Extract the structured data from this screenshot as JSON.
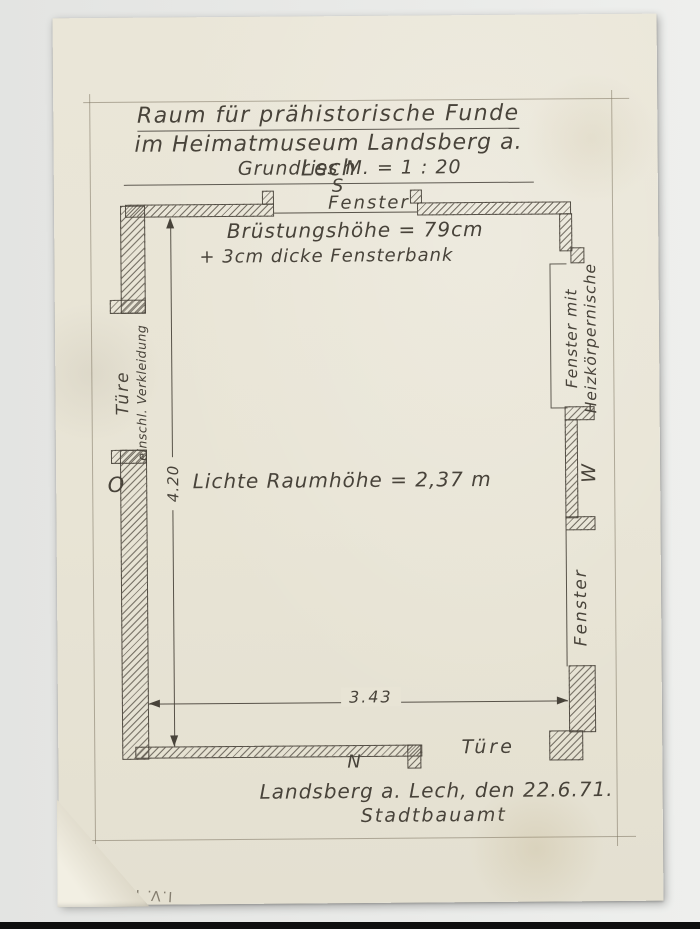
{
  "doc": {
    "title1": "Raum für prähistorische Funde",
    "title2": "im Heimatmuseum Landsberg a. Lech",
    "scale": "Grundriss  M. = 1 : 20",
    "place_date": "Landsberg a. Lech, den 22.6.71.",
    "office": "Stadtbauamt",
    "inventory": "I.V. H392"
  },
  "plan": {
    "compass": {
      "s": "S",
      "n": "N",
      "o": "O",
      "w": "W"
    },
    "top_window": "Fenster",
    "parapet1": "Brüstungshöhe = 79cm",
    "parapet2": "+ 3cm dicke Fensterbank",
    "room_height": "Lichte Raumhöhe  =  2,37 m",
    "door_left1": "Türe",
    "door_left2": "einschl. Verkleidung",
    "niche1": "Fenster mit",
    "niche2": "Heizkörpernische",
    "window_right": "Fenster",
    "door_bottom": "Türe",
    "dim_w": "3.43",
    "dim_h": "4.20"
  },
  "colors": {
    "paper": "#e8e4d5",
    "ink": "#48433a",
    "pencil": "#8d8674",
    "background": "#e7e8e6"
  }
}
